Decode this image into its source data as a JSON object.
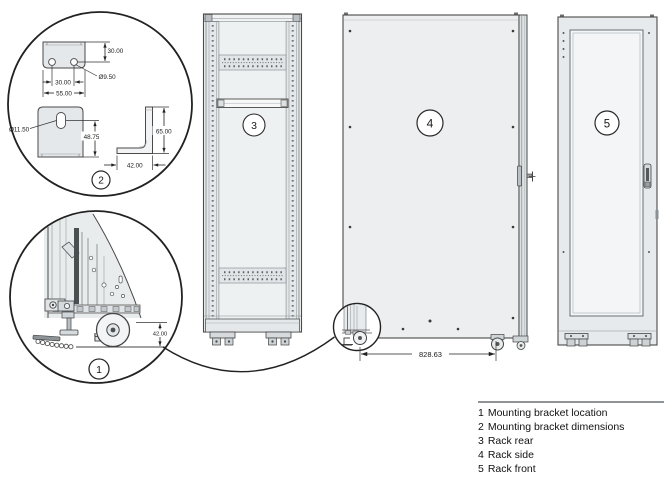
{
  "callouts": [
    {
      "num": "1",
      "label": "Mounting bracket location"
    },
    {
      "num": "2",
      "label": "Mounting bracket dimensions"
    },
    {
      "num": "3",
      "label": "Rack rear"
    },
    {
      "num": "4",
      "label": "Rack side"
    },
    {
      "num": "5",
      "label": "Rack front"
    }
  ],
  "dimensions": {
    "bracket_top_plate": {
      "edge_to_hole": "30.00",
      "hole_spacing": "30.00",
      "hole_diameter": "Ø9.50",
      "width": "55.00"
    },
    "bracket_side_plate": {
      "slot_diameter": "Ø11.50",
      "height": "48.75"
    },
    "angle_bracket": {
      "height": "65.00",
      "depth": "42.00"
    },
    "bracket_height_from_floor": "42.00",
    "caster_spacing": "828.63"
  },
  "colors": {
    "line": "#3a3a3a",
    "panel": "#eceef0",
    "panel_light": "#f3f5f6",
    "strip": "#e2e6e8",
    "background": "#ffffff"
  }
}
